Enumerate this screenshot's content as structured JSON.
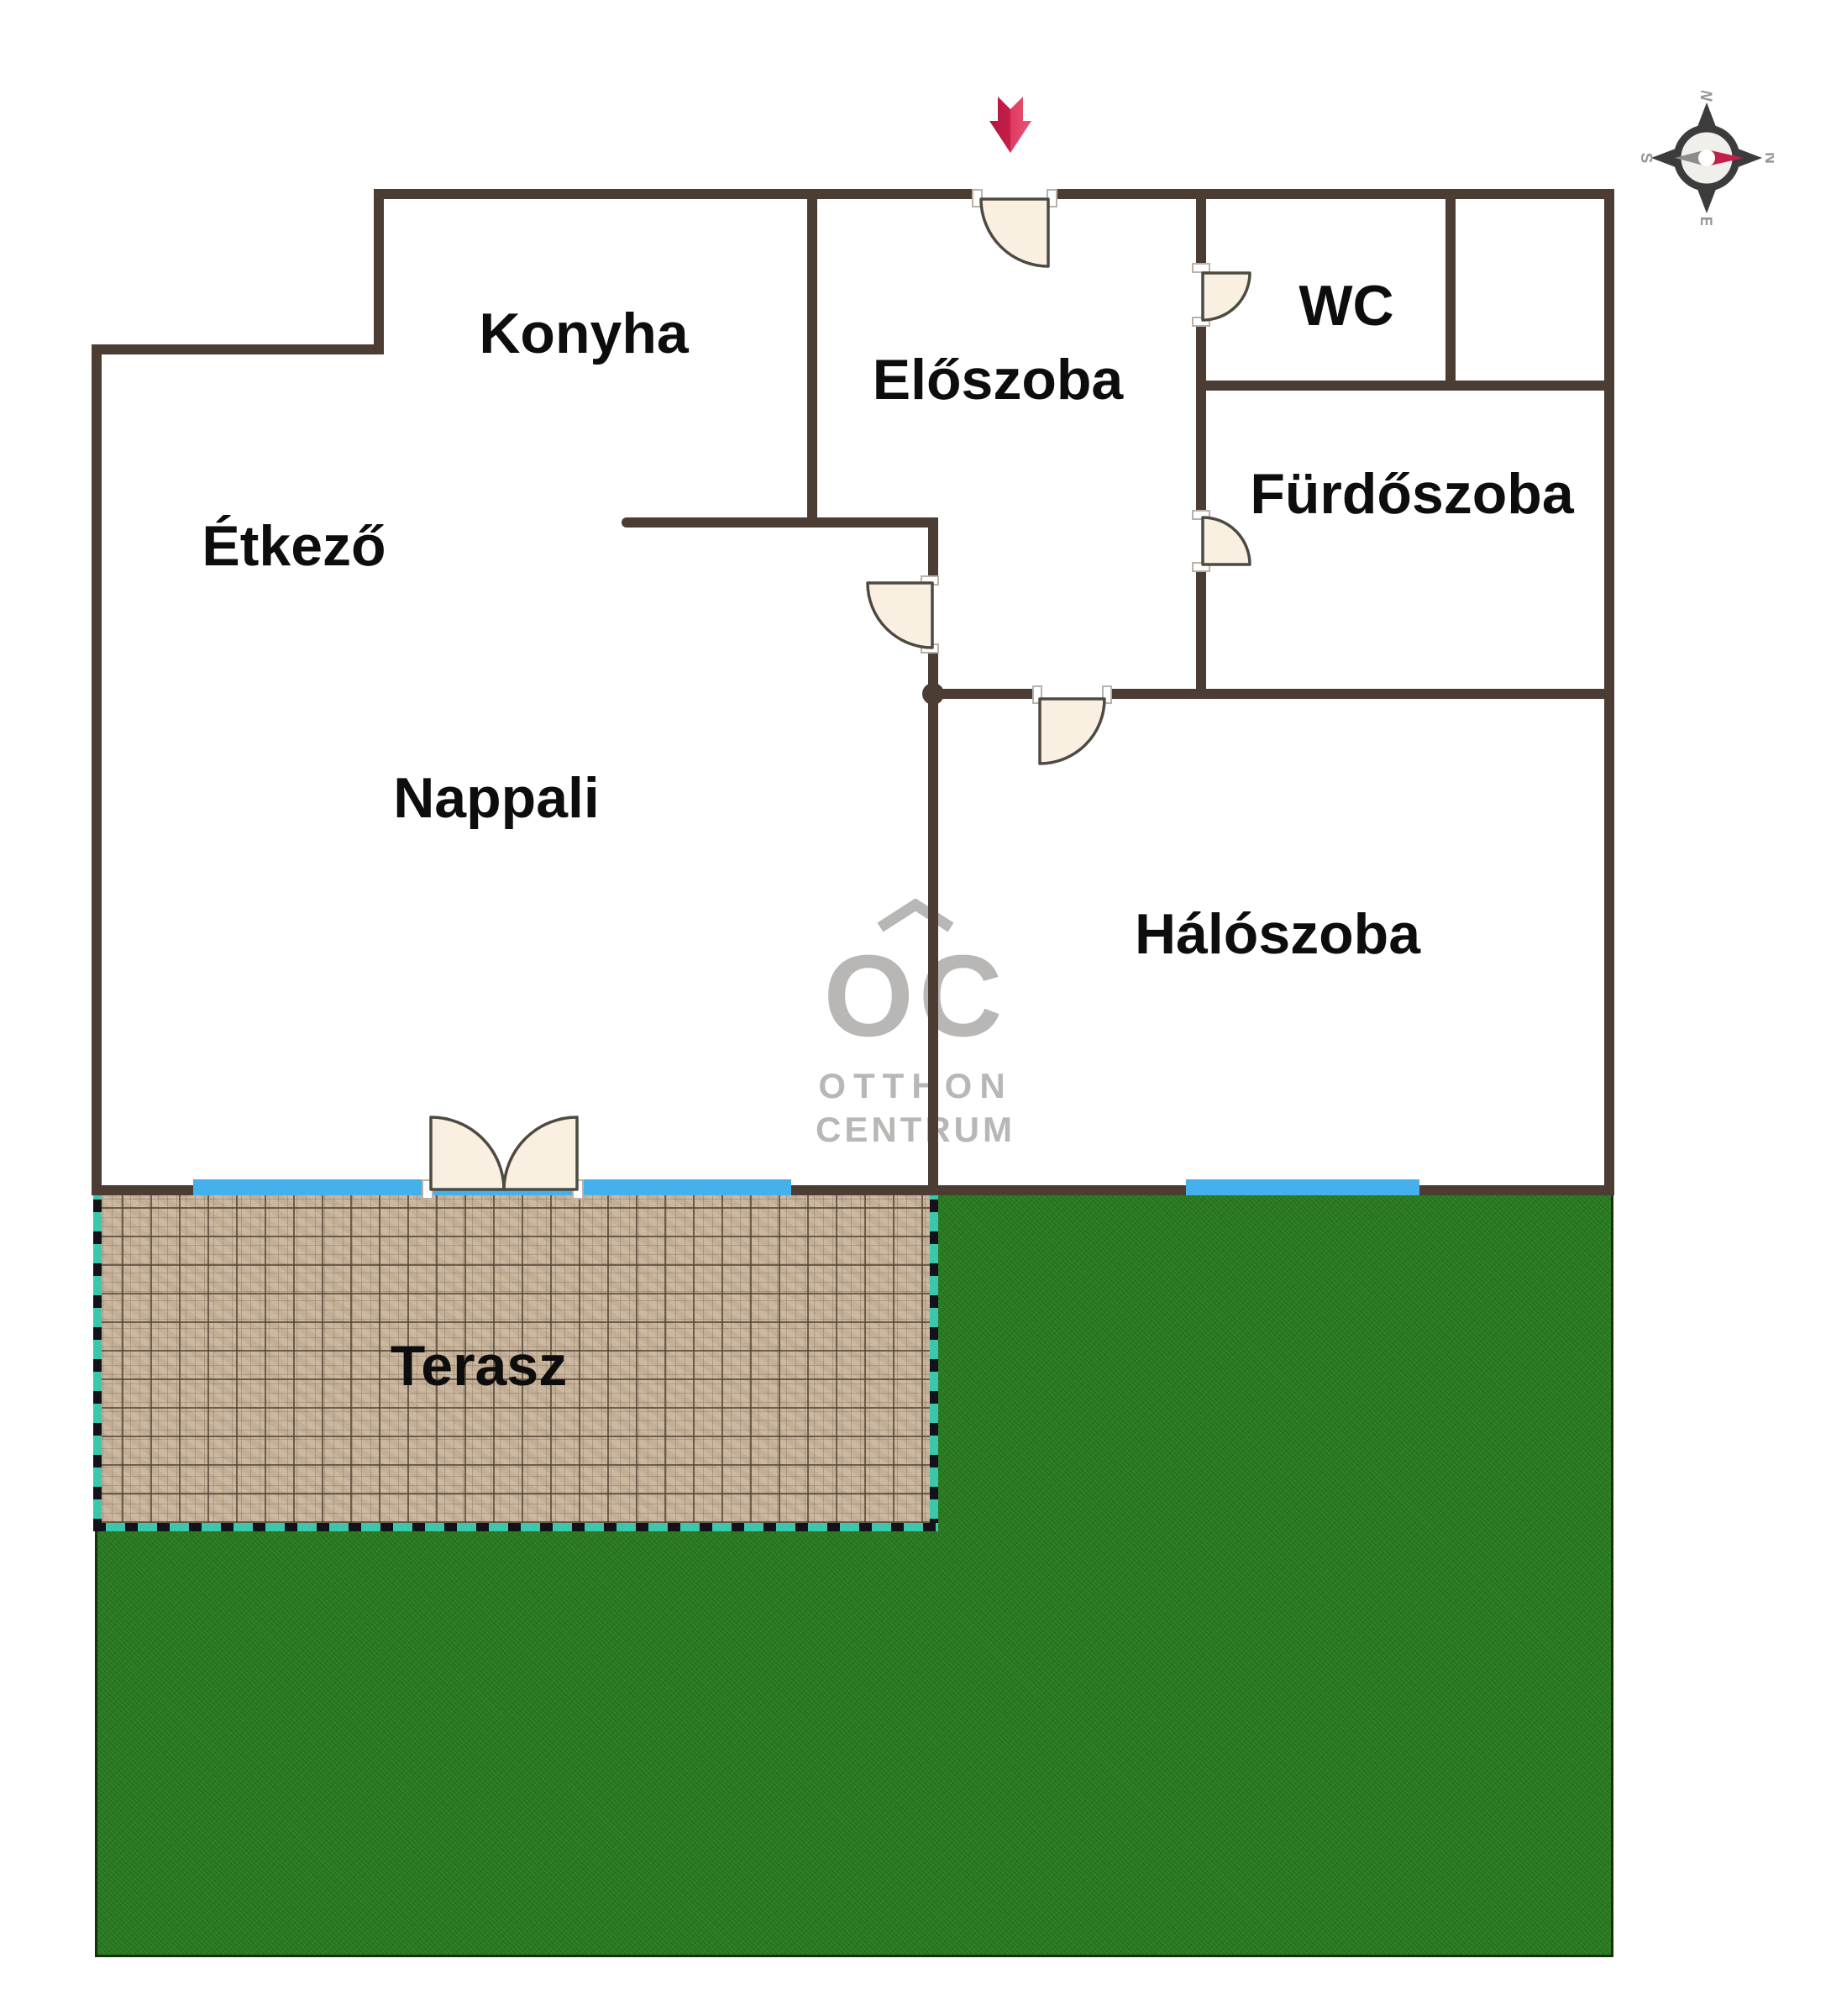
{
  "plan": {
    "title": "apartment-floor-plan",
    "rooms": [
      {
        "name": "konyha",
        "label": "Konyha"
      },
      {
        "name": "eloszoba",
        "label": "Előszoba"
      },
      {
        "name": "wc",
        "label": "WC"
      },
      {
        "name": "furdoszoba",
        "label": "Fürdőszoba"
      },
      {
        "name": "etkezo",
        "label": "Étkező"
      },
      {
        "name": "nappali",
        "label": "Nappali"
      },
      {
        "name": "haloszoba",
        "label": "Hálószoba"
      },
      {
        "name": "terasz",
        "label": "Terasz"
      }
    ],
    "watermark": {
      "logo": "OC",
      "line1": "OTTHON",
      "line2": "CENTRUM"
    },
    "compass": {
      "n": "N",
      "e": "E",
      "s": "S",
      "w": "W"
    },
    "colors": {
      "wall": "#4b3d33",
      "window_blue": "#45b1ec",
      "terrace_tile": "#c9b49b",
      "terrace_border_teal": "#3bc7ab",
      "grass_green": "#2b7e22",
      "door_fill": "#faf0e2",
      "entrance_arrow_red": "#d01f4c",
      "label_text": "#0d0d0d",
      "watermark_gray": "#b9b7b5"
    }
  }
}
